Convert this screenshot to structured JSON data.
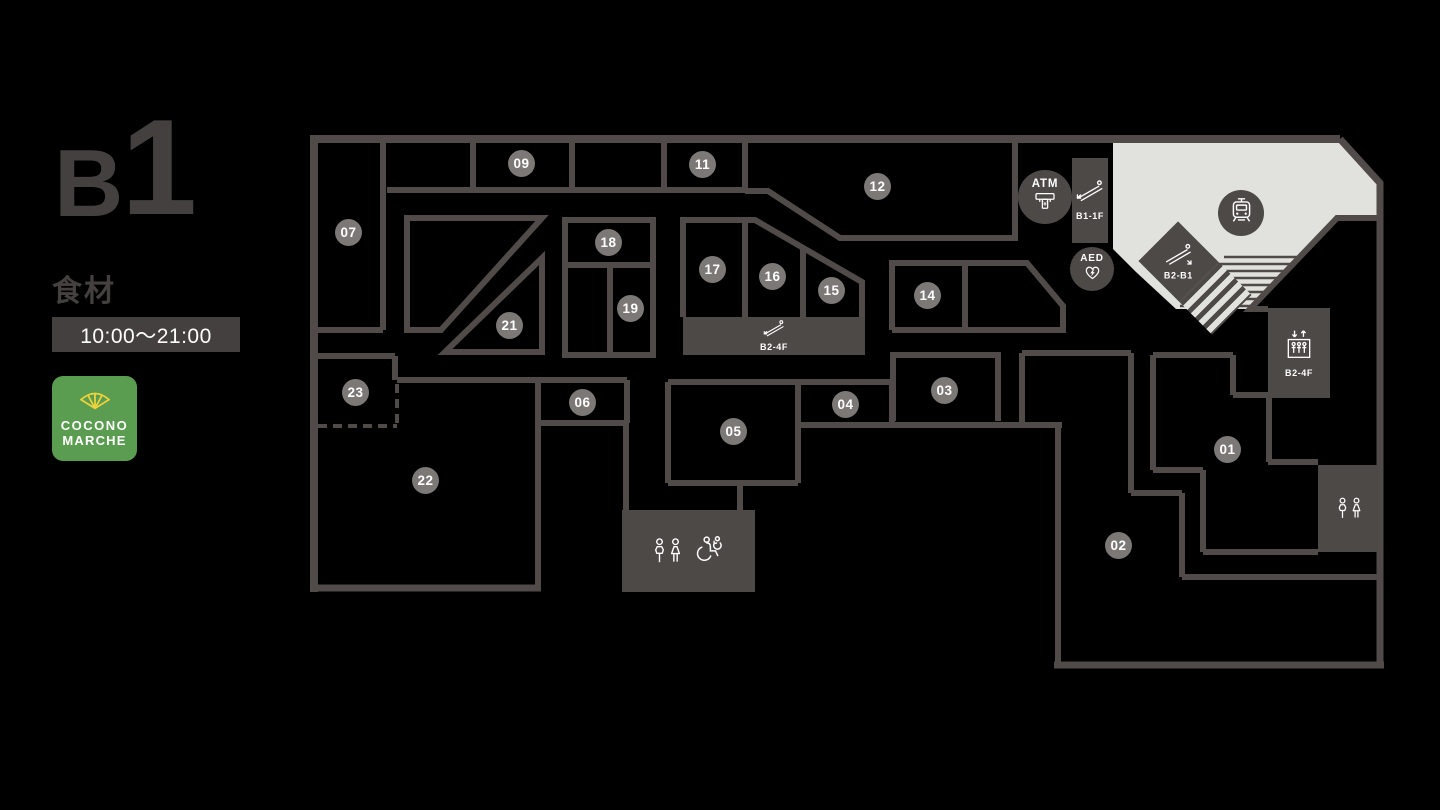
{
  "panel": {
    "floor_letter": "B",
    "floor_digit": "1",
    "category": "食材",
    "hours": "10:00〜21:00",
    "logo_line1": "COCONO",
    "logo_line2": "MARCHE"
  },
  "map": {
    "shops": [
      {
        "id": "01"
      },
      {
        "id": "02"
      },
      {
        "id": "03"
      },
      {
        "id": "04"
      },
      {
        "id": "05"
      },
      {
        "id": "06"
      },
      {
        "id": "07"
      },
      {
        "id": "09"
      },
      {
        "id": "11"
      },
      {
        "id": "12"
      },
      {
        "id": "14"
      },
      {
        "id": "15"
      },
      {
        "id": "16"
      },
      {
        "id": "17"
      },
      {
        "id": "18"
      },
      {
        "id": "19"
      },
      {
        "id": "21"
      },
      {
        "id": "22"
      },
      {
        "id": "23"
      }
    ],
    "facilities": {
      "atm": {
        "label": "ATM",
        "icon": "atm-icon"
      },
      "aed": {
        "label": "AED",
        "icon": "aed-heart-icon"
      },
      "station": {
        "icon": "train-icon"
      },
      "escalator_b1_1f": {
        "label": "B1-1F",
        "icon": "escalator-icon"
      },
      "escalator_b2_b1": {
        "label": "B2-B1",
        "icon": "escalator-icon"
      },
      "escalator_b2_4f": {
        "label": "B2-4F",
        "icon": "escalator-icon"
      },
      "elevator_b2_4f": {
        "label": "B2-4F",
        "icon": "elevator-icon"
      },
      "restroom_center": {
        "icons": [
          "mens-womens-restroom-icon",
          "accessible-restroom-icon"
        ]
      },
      "restroom_east": {
        "icons": [
          "mens-womens-restroom-icon"
        ]
      }
    },
    "colors": {
      "background": "#000000",
      "wall": "#504B48",
      "block": "#4D4946",
      "shop_circle": "#7B7876",
      "station_area": "#E1E2DE",
      "text_dark": "#454040",
      "logo_green": "#5A9C50",
      "logo_yellow": "#F0D23C"
    }
  }
}
